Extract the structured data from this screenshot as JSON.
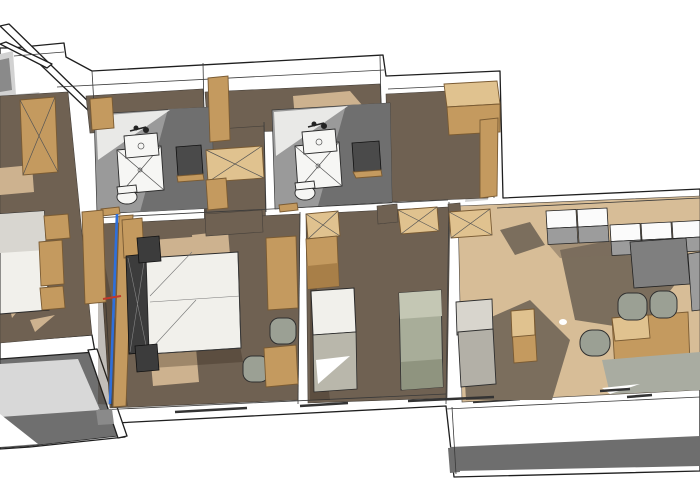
{
  "meta": {
    "kind": "3d-floor-plan-rendering",
    "view": "axonometric-top-down",
    "visible_text": []
  },
  "colors": {
    "wall_white": "#ffffff",
    "outline": "#1f1f1f",
    "wall_shadow": "#d2d2d2",
    "gray2": "#8a8a8a",
    "floor_dark": "#6f6152",
    "floor_light": "#d7bd97",
    "wood_light": "#cdb28f",
    "floor_shadow": "rgba(50,38,24,0.30)",
    "shadow_brown": "#7b6e5d",
    "bath_floor": "#9a9a9a",
    "bath_floor_dark": "#6f6f6f",
    "furniture_wood": "#c49a5f",
    "wood_top": "#e0c28f",
    "wood_edge": "#7a5b33",
    "dark_furniture": "#3c3c3c",
    "fixture_white": "#f6f6f4",
    "mirror_dark": "#4a4a4a",
    "bed_white": "#f1f0eb",
    "bed_gray": "#b9b7ab",
    "bed_green": "#a8ad99",
    "seat_gray": "#9ba094",
    "cabinet_white": "#fbfbfb",
    "cabinet_gray": "#9c9c9c",
    "appliance_gray": "#7f7f7f",
    "rug_gray": "#a9aca1",
    "terrace_light": "#d8d8d8",
    "terrace_dark": "#6f6f6f",
    "balcony_band": "#6e6e6e",
    "sofa_back": "#d8d5cd",
    "sofa_seat": "#b3b0a7",
    "section_blue": "#2e6fdb",
    "marker_red": "#c0392b"
  },
  "scene": {
    "rooms": [
      {
        "id": "bedroom-left",
        "floor": "dark-wood"
      },
      {
        "id": "bedroom-2-entry",
        "floor": "dark-wood"
      },
      {
        "id": "bathroom-1",
        "floor": "gray-tile"
      },
      {
        "id": "hallway-wardrobe",
        "floor": "dark-wood"
      },
      {
        "id": "bedroom-3-entry",
        "floor": "dark-wood"
      },
      {
        "id": "bathroom-2",
        "floor": "gray-tile"
      },
      {
        "id": "room-top-right",
        "floor": "dark-wood"
      },
      {
        "id": "master-bedroom",
        "floor": "dark-wood"
      },
      {
        "id": "twin-bedroom",
        "floor": "dark-wood"
      },
      {
        "id": "living-kitchen",
        "floor": "light-wood"
      },
      {
        "id": "terrace-left",
        "floor": "gray-concrete"
      },
      {
        "id": "balcony-bottom",
        "floor": "white"
      }
    ],
    "furniture": [
      "wardrobes",
      "double-bed",
      "nightstands",
      "single-beds",
      "shower",
      "washbasin",
      "toilet",
      "wall-mirror",
      "kitchen-cabinets",
      "fridge",
      "sofa",
      "coffee-table",
      "dining-table",
      "chairs",
      "rug",
      "corner-cabinet"
    ],
    "annotations": [
      {
        "id": "section-cut-line",
        "color_key": "section_blue"
      },
      {
        "id": "section-cut-tick",
        "color_key": "marker_red"
      }
    ]
  }
}
